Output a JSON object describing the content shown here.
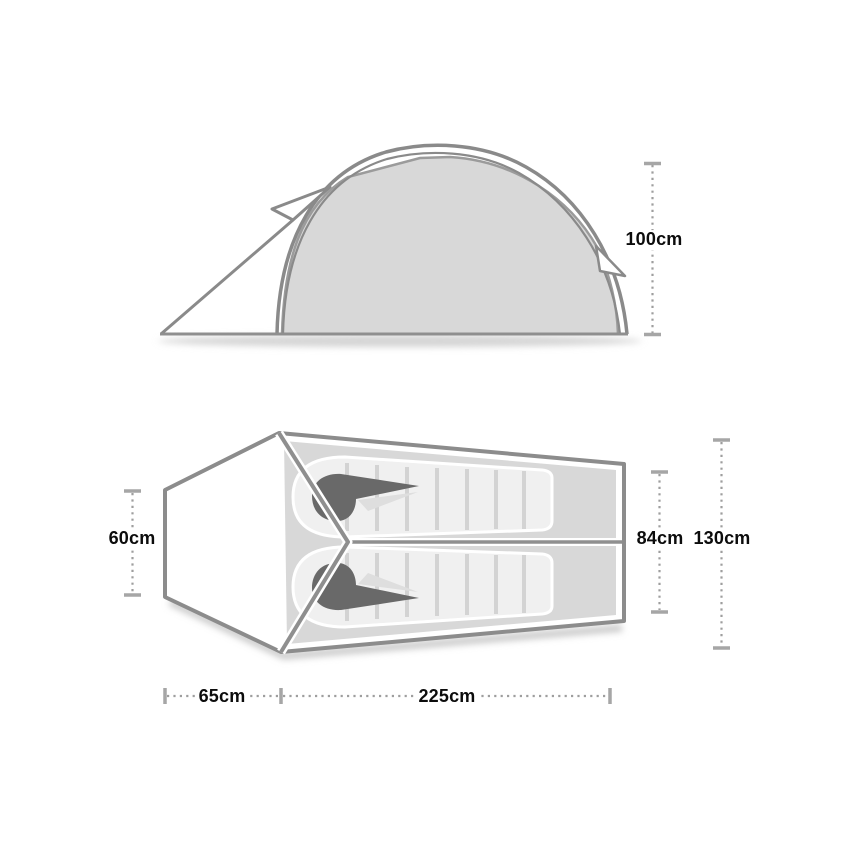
{
  "diagram": {
    "subject": "two-person tent dimension diagram",
    "side_view_name": "tent-side-elevation",
    "floor_plan_name": "tent-floor-plan"
  },
  "dimensions": {
    "height": "100cm",
    "rear_width": "60cm",
    "inner_width": "84cm",
    "overall_width": "130cm",
    "vestibule_length": "65cm",
    "inner_length": "225cm"
  },
  "colors": {
    "outline_gray": "#8c8c8c",
    "floor_gray": "#d8d8d8",
    "sleeping_bag_gray": "#f0f0f0",
    "baffle_gray": "#d3d3d3",
    "hood_dark_gray": "#696969",
    "dimension_line_gray": "#9e9e9e",
    "dimension_cap_gray": "#a6a6a6",
    "text_black": "#0c0c0c",
    "background": "#ffffff"
  }
}
